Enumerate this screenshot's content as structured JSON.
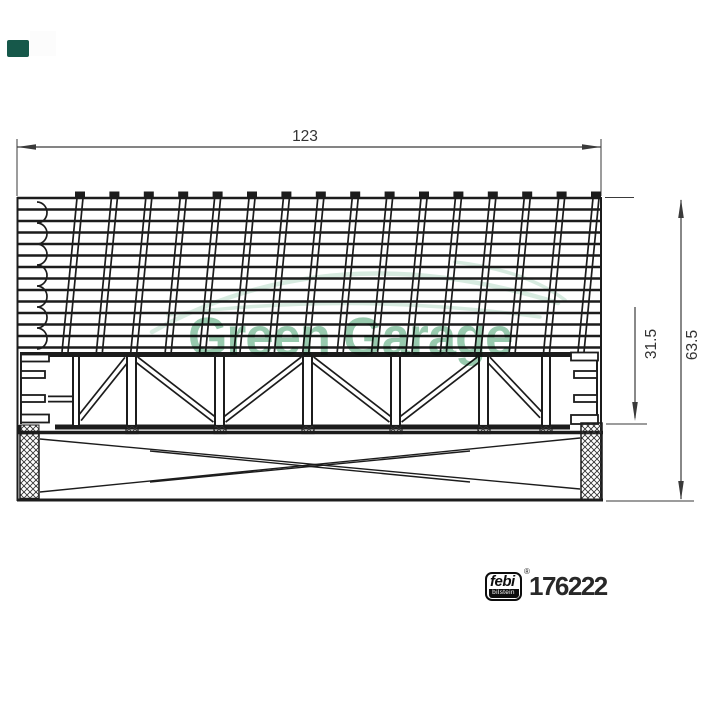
{
  "watermark": {
    "brand_text": "Green Garage",
    "text_color": "#8cc3a4",
    "swoosh_color": "#d7ebe0",
    "logo_block_color": "#16584a"
  },
  "dimension_labels": {
    "width": "123",
    "element_height": "31.5",
    "total_height": "63.5"
  },
  "footer": {
    "brand": "febi",
    "brand_sub": "bilstein",
    "registered": "®",
    "part_number": "176222"
  },
  "drawing": {
    "line_color": "#1c1c1c",
    "dim_color": "#3a3a3a"
  }
}
